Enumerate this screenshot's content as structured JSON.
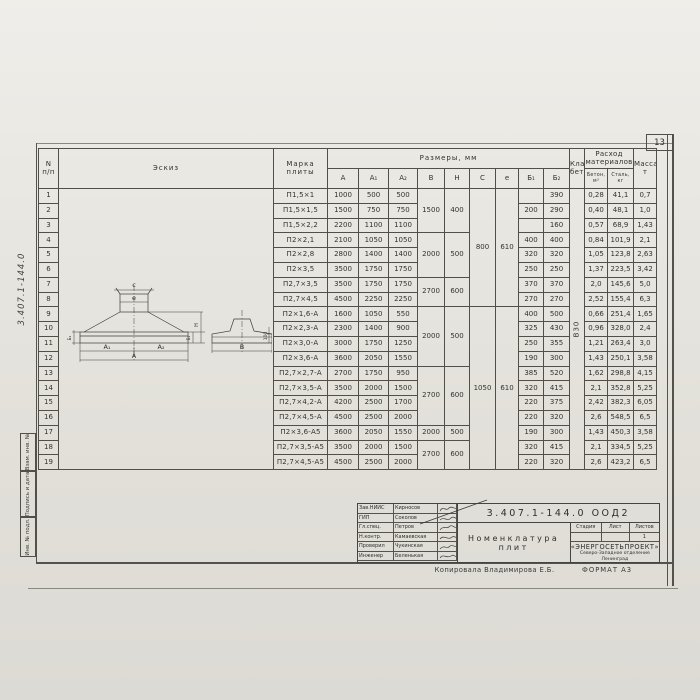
{
  "page": {
    "number": "13",
    "margin_code": "3.407.1-144.0",
    "stamps": [
      "Взам. инв. №",
      "Подпись и дата",
      "Инв. № подл."
    ],
    "copied_by": "Копировала Владимирова Е.Б.",
    "format": "ФОРМАТ А3"
  },
  "table": {
    "header": {
      "num": "N\nп/п",
      "sketch": "Эскиз",
      "marka": "Марка\nплиты",
      "razmery": "Размеры,  мм",
      "dims": [
        "A",
        "A₁",
        "A₂",
        "B",
        "H",
        "C",
        "e",
        "Б₁",
        "Б₂"
      ],
      "klass": "Класс\nбетона",
      "rashod": "Расход\nматериалов",
      "beton": "Бетон,\nм³",
      "stal": "Сталь,\nкг",
      "massa": "Масса,\nт"
    },
    "concrete_class": "В30",
    "rows": [
      {
        "n": "1",
        "marka": "П1,5×1",
        "a": "1000",
        "a1": "500",
        "a2": "500",
        "b": "1500",
        "h": "400",
        "c": "800",
        "e": "610",
        "b1": "",
        "b2": "390",
        "beton": "0,28",
        "stal": "41,1",
        "massa": "0,7"
      },
      {
        "n": "2",
        "marka": "П1,5×1,5",
        "a": "1500",
        "a1": "750",
        "a2": "750",
        "b": "1500",
        "h": "400",
        "c": "800",
        "e": "610",
        "b1": "200",
        "b2": "290",
        "beton": "0,40",
        "stal": "48,1",
        "massa": "1,0"
      },
      {
        "n": "3",
        "marka": "П1,5×2,2",
        "a": "2200",
        "a1": "1100",
        "a2": "1100",
        "b": "1500",
        "h": "400",
        "c": "800",
        "e": "610",
        "b1": "",
        "b2": "160",
        "beton": "0,57",
        "stal": "68,9",
        "massa": "1,43"
      },
      {
        "n": "4",
        "marka": "П2×2,1",
        "a": "2100",
        "a1": "1050",
        "a2": "1050",
        "b": "2000",
        "h": "500",
        "c": "800",
        "e": "610",
        "b1": "400",
        "b2": "400",
        "beton": "0,84",
        "stal": "101,9",
        "massa": "2,1"
      },
      {
        "n": "5",
        "marka": "П2×2,8",
        "a": "2800",
        "a1": "1400",
        "a2": "1400",
        "b": "2000",
        "h": "500",
        "c": "800",
        "e": "610",
        "b1": "320",
        "b2": "320",
        "beton": "1,05",
        "stal": "123,8",
        "massa": "2,63"
      },
      {
        "n": "6",
        "marka": "П2×3,5",
        "a": "3500",
        "a1": "1750",
        "a2": "1750",
        "b": "2000",
        "h": "500",
        "c": "800",
        "e": "610",
        "b1": "250",
        "b2": "250",
        "beton": "1,37",
        "stal": "223,5",
        "massa": "3,42"
      },
      {
        "n": "7",
        "marka": "П2,7×3,5",
        "a": "3500",
        "a1": "1750",
        "a2": "1750",
        "b": "2700",
        "h": "600",
        "c": "800",
        "e": "610",
        "b1": "370",
        "b2": "370",
        "beton": "2,0",
        "stal": "145,6",
        "massa": "5,0"
      },
      {
        "n": "8",
        "marka": "П2,7×4,5",
        "a": "4500",
        "a1": "2250",
        "a2": "2250",
        "b": "2700",
        "h": "600",
        "c": "800",
        "e": "610",
        "b1": "270",
        "b2": "270",
        "beton": "2,52",
        "stal": "155,4",
        "massa": "6,3"
      },
      {
        "n": "9",
        "marka": "П2×1,6-А",
        "a": "1600",
        "a1": "1050",
        "a2": "550",
        "b": "2000",
        "h": "500",
        "c": "1050",
        "e": "610",
        "b1": "400",
        "b2": "500",
        "beton": "0,66",
        "stal": "251,4",
        "massa": "1,65"
      },
      {
        "n": "10",
        "marka": "П2×2,3-А",
        "a": "2300",
        "a1": "1400",
        "a2": "900",
        "b": "2000",
        "h": "500",
        "c": "1050",
        "e": "610",
        "b1": "325",
        "b2": "430",
        "beton": "0,96",
        "stal": "328,0",
        "massa": "2,4"
      },
      {
        "n": "11",
        "marka": "П2×3,0-А",
        "a": "3000",
        "a1": "1750",
        "a2": "1250",
        "b": "2000",
        "h": "500",
        "c": "1050",
        "e": "610",
        "b1": "250",
        "b2": "355",
        "beton": "1,21",
        "stal": "263,4",
        "massa": "3,0"
      },
      {
        "n": "12",
        "marka": "П2×3,6-А",
        "a": "3600",
        "a1": "2050",
        "a2": "1550",
        "b": "2000",
        "h": "500",
        "c": "1050",
        "e": "610",
        "b1": "190",
        "b2": "300",
        "beton": "1,43",
        "stal": "250,1",
        "massa": "3,58"
      },
      {
        "n": "13",
        "marka": "П2,7×2,7-А",
        "a": "2700",
        "a1": "1750",
        "a2": "950",
        "b": "2700",
        "h": "600",
        "c": "1050",
        "e": "610",
        "b1": "385",
        "b2": "520",
        "beton": "1,62",
        "stal": "298,8",
        "massa": "4,15"
      },
      {
        "n": "14",
        "marka": "П2,7×3,5-А",
        "a": "3500",
        "a1": "2000",
        "a2": "1500",
        "b": "2700",
        "h": "600",
        "c": "1050",
        "e": "610",
        "b1": "320",
        "b2": "415",
        "beton": "2,1",
        "stal": "352,8",
        "massa": "5,25"
      },
      {
        "n": "15",
        "marka": "П2,7×4,2-А",
        "a": "4200",
        "a1": "2500",
        "a2": "1700",
        "b": "2700",
        "h": "600",
        "c": "1050",
        "e": "610",
        "b1": "220",
        "b2": "375",
        "beton": "2,42",
        "stal": "382,3",
        "massa": "6,05"
      },
      {
        "n": "16",
        "marka": "П2,7×4,5-А",
        "a": "4500",
        "a1": "2500",
        "a2": "2000",
        "b": "2700",
        "h": "600",
        "c": "1050",
        "e": "610",
        "b1": "220",
        "b2": "320",
        "beton": "2,6",
        "stal": "548,5",
        "massa": "6,5"
      },
      {
        "n": "17",
        "marka": "П2×3,6-А5",
        "a": "3600",
        "a1": "2050",
        "a2": "1550",
        "b": "2000",
        "h": "500",
        "c": "1050",
        "e": "610",
        "b1": "190",
        "b2": "300",
        "beton": "1,43",
        "stal": "450,3",
        "massa": "3,58"
      },
      {
        "n": "18",
        "marka": "П2,7×3,5-А5",
        "a": "3500",
        "a1": "2000",
        "a2": "1500",
        "b": "2700",
        "h": "600",
        "c": "1050",
        "e": "610",
        "b1": "320",
        "b2": "415",
        "beton": "2,1",
        "stal": "334,5",
        "massa": "5,25"
      },
      {
        "n": "19",
        "marka": "П2,7×4,5-А5",
        "a": "4500",
        "a1": "2500",
        "a2": "2000",
        "b": "2700",
        "h": "600",
        "c": "1050",
        "e": "610",
        "b1": "220",
        "b2": "320",
        "beton": "2,6",
        "stal": "423,2",
        "massa": "6,5"
      }
    ]
  },
  "sketch": {
    "labels": {
      "c": "c",
      "e": "e",
      "a1": "A₁",
      "a2": "A₂",
      "a": "A",
      "b": "B",
      "h": "H",
      "b1": "Б₁",
      "b2": "Б₂",
      "edge": "100"
    }
  },
  "titleblock": {
    "doc_number": "3.407.1-144.0  ООД2",
    "title": "Номенклатура\nплит",
    "stage_label": "Стадия",
    "sheet_label": "Лист",
    "sheets_label": "Листов",
    "sheets_value": "1",
    "org_name": "«ЭНЕРГОСЕТЬПРОЕКТ»",
    "org_branch": "Северо-Западное отделение",
    "org_city": "Ленинград",
    "people": [
      {
        "role": "Зав.НИИС",
        "name": "Кирносов"
      },
      {
        "role": "ГИП",
        "name": "Соколов"
      },
      {
        "role": "Гл.спец.",
        "name": "Петров"
      },
      {
        "role": "Н.контр.",
        "name": "Камаевская"
      },
      {
        "role": "Проверил",
        "name": "Чукинская"
      },
      {
        "role": "Инженер",
        "name": "Беленькая"
      }
    ]
  }
}
